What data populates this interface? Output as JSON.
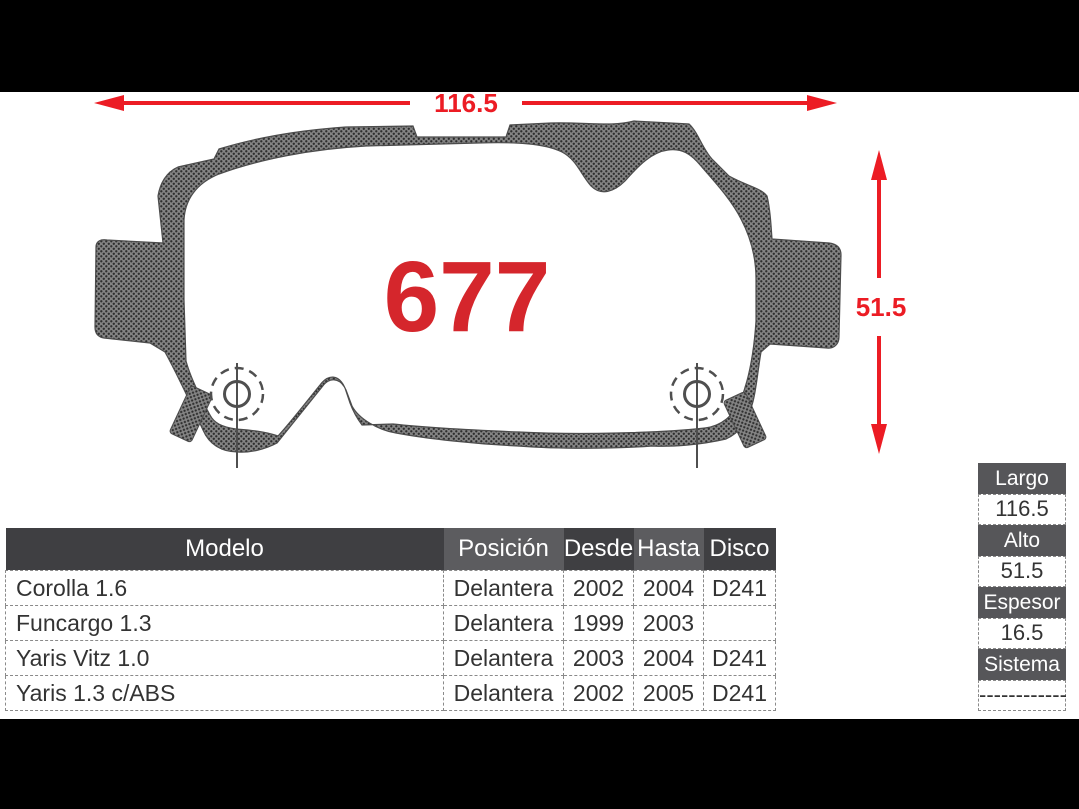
{
  "part": {
    "number": "677"
  },
  "dimensions": {
    "width": "116.5",
    "height": "51.5"
  },
  "applications_table": {
    "headers": [
      "Modelo",
      "Posición",
      "Desde",
      "Hasta",
      "Disco"
    ],
    "rows": [
      [
        "Corolla 1.6",
        "Delantera",
        "2002",
        "2004",
        "D241"
      ],
      [
        "Funcargo 1.3",
        "Delantera",
        "1999",
        "2003",
        ""
      ],
      [
        "Yaris Vitz 1.0",
        "Delantera",
        "2003",
        "2004",
        "D241"
      ],
      [
        "Yaris 1.3 c/ABS",
        "Delantera",
        "2002",
        "2005",
        "D241"
      ]
    ]
  },
  "specs_table": {
    "items": [
      {
        "label": "Largo",
        "value": "116.5"
      },
      {
        "label": "Alto",
        "value": "51.5"
      },
      {
        "label": "Espesor",
        "value": "16.5"
      },
      {
        "label": "Sistema",
        "value": "------------"
      }
    ]
  },
  "colors": {
    "dimension_red": "#ec1c24",
    "part_number_red": "#d5262c",
    "table_header_dark": "#3f3f42",
    "table_header_light": "#5c5c5f",
    "specs_header_gray": "#565659",
    "frame_black": "#000000"
  }
}
